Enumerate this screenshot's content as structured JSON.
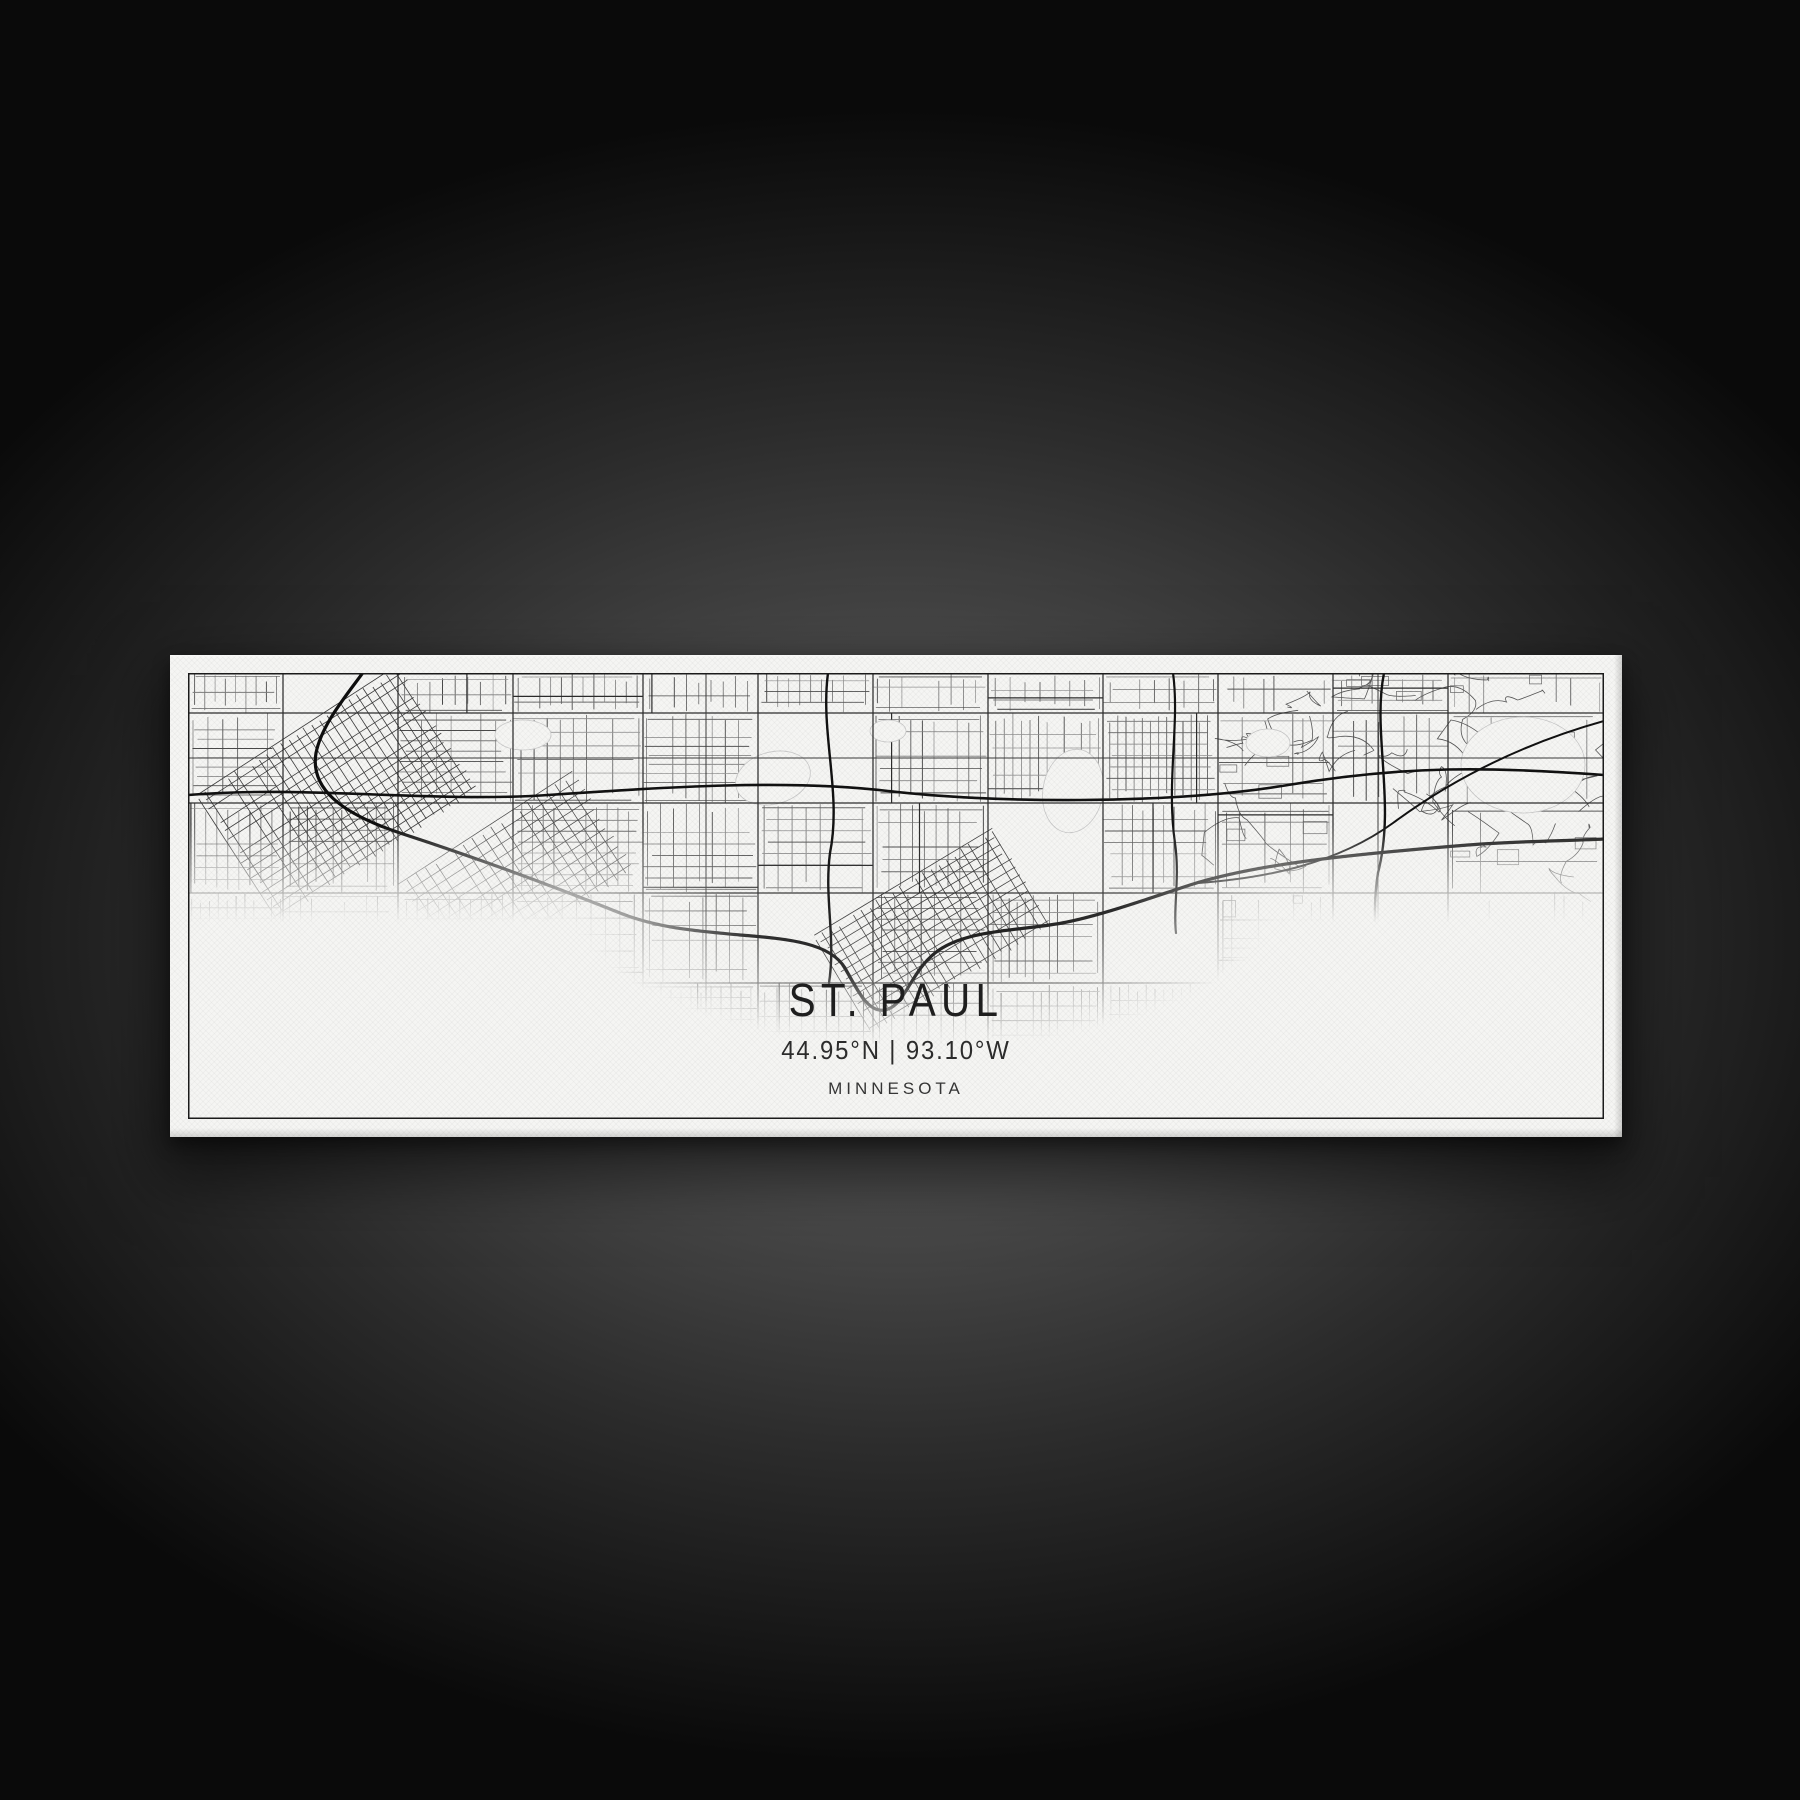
{
  "artwork": {
    "title": "ST. PAUL",
    "coordinates": "44.95°N | 93.10°W",
    "region": "MINNESOTA"
  },
  "map": {
    "style": "minimal-line-street-map",
    "ink_fade": "map fades to white above title block"
  },
  "colors": {
    "paper": "#f5f5f3",
    "border_ink": "#1b1b1b",
    "street_minor": "#6e6e6e",
    "street_major": "#2d2d2d",
    "highway_river": "#111111",
    "backdrop_glow": "#5c5c5c",
    "backdrop_dark": "#0a0a0a",
    "text": "#1f1f1f"
  }
}
